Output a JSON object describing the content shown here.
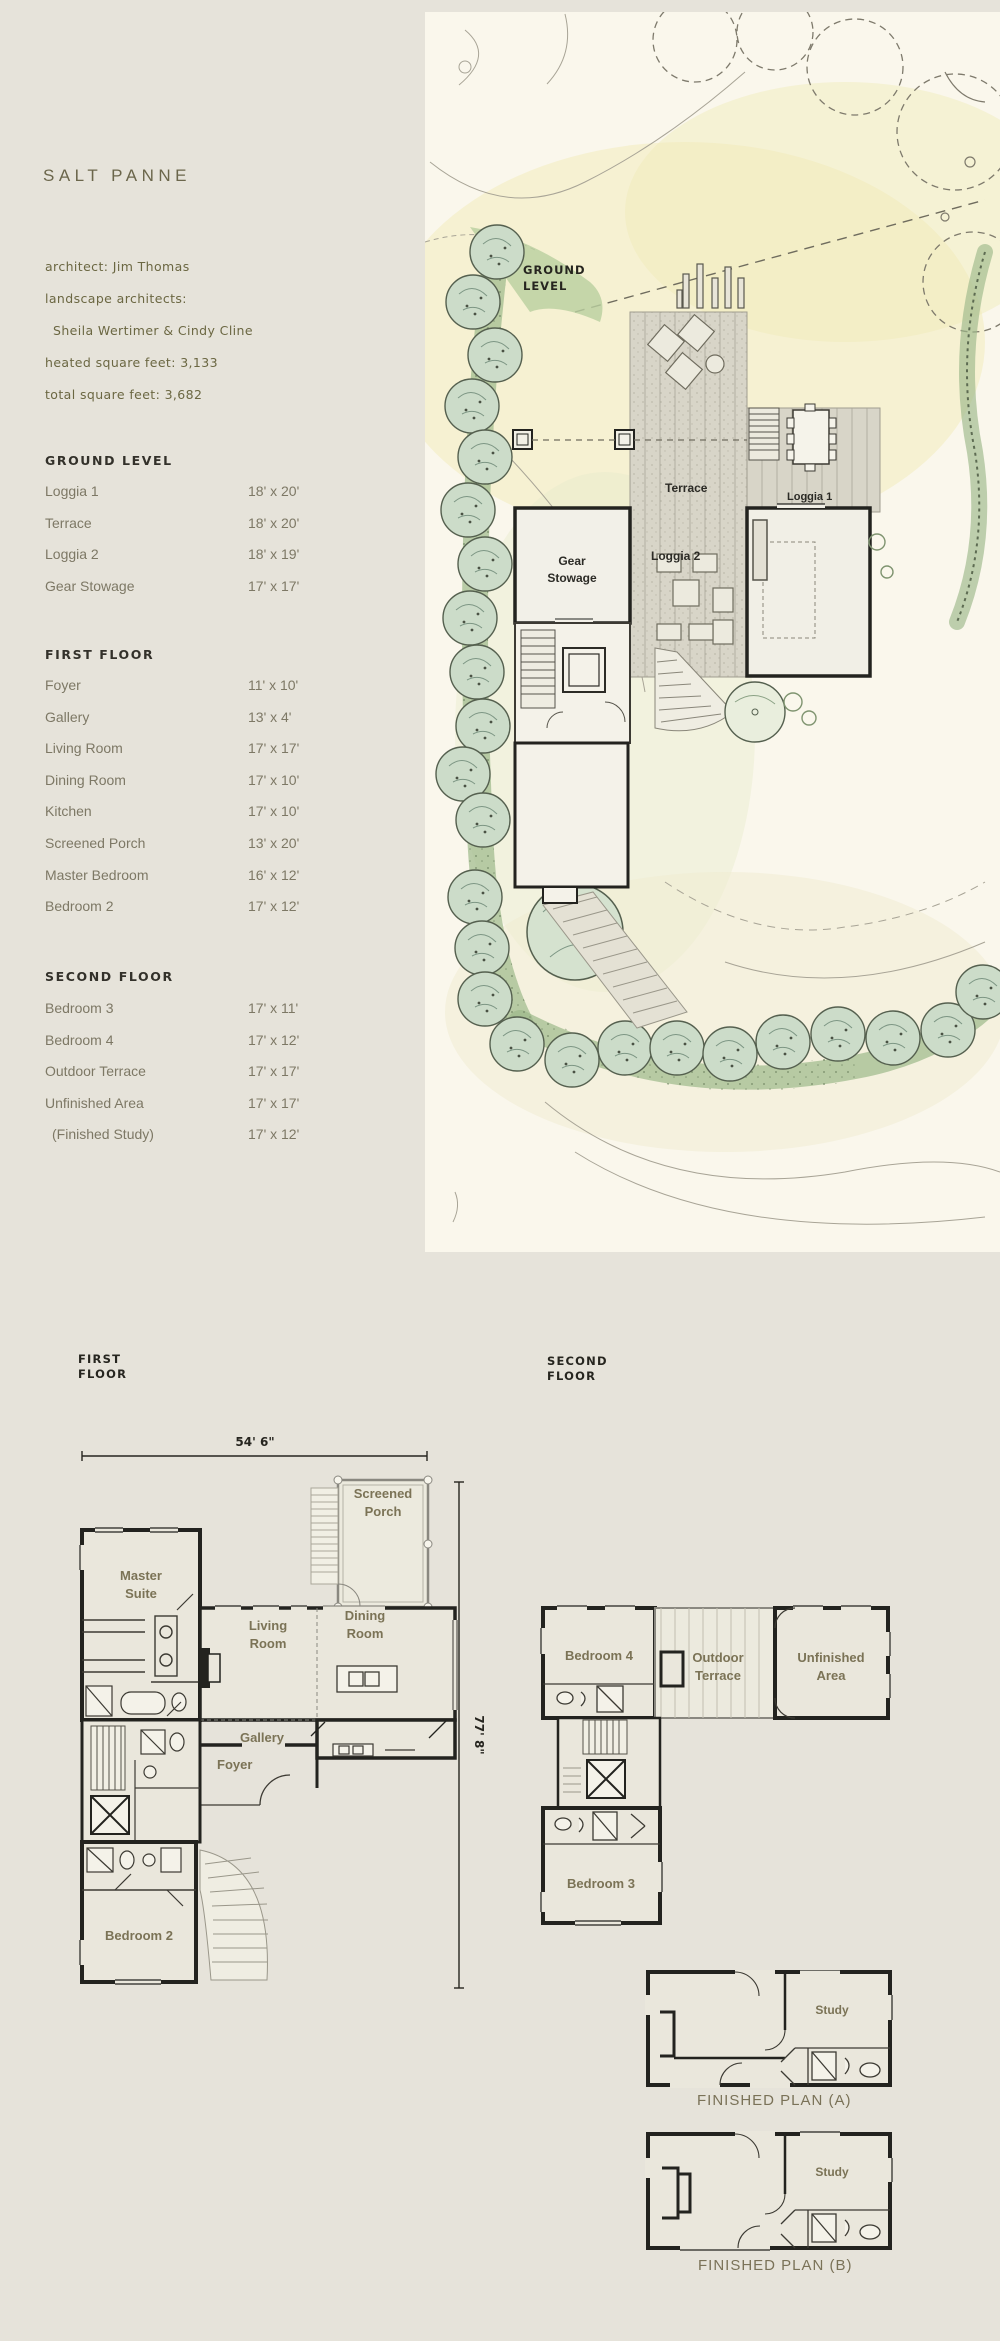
{
  "page": {
    "title": "SALT PANNE"
  },
  "info": {
    "line1": "architect: Jim Thomas",
    "line2": "landscape architects:",
    "line3": "Sheila Wertimer & Cindy Cline",
    "line4": "heated square feet: 3,133",
    "line5": "total square feet: 3,682"
  },
  "room_tables": [
    {
      "header": "GROUND LEVEL",
      "rows": [
        {
          "name": "Loggia 1",
          "dim": "18' x 20'"
        },
        {
          "name": "Terrace",
          "dim": "18' x 20'"
        },
        {
          "name": "Loggia 2",
          "dim": "18' x 19'"
        },
        {
          "name": "Gear Stowage",
          "dim": "17' x 17'"
        }
      ]
    },
    {
      "header": "FIRST FLOOR",
      "rows": [
        {
          "name": "Foyer",
          "dim": "11' x 10'"
        },
        {
          "name": "Gallery",
          "dim": "13' x 4'"
        },
        {
          "name": "Living Room",
          "dim": "17' x 17'"
        },
        {
          "name": "Dining Room",
          "dim": "17' x 10'"
        },
        {
          "name": "Kitchen",
          "dim": "17' x 10'"
        },
        {
          "name": "Screened Porch",
          "dim": "13' x 20'"
        },
        {
          "name": "Master Bedroom",
          "dim": "16' x 12'"
        },
        {
          "name": "Bedroom 2",
          "dim": "17' x 12'"
        }
      ]
    },
    {
      "header": "SECOND FLOOR",
      "rows": [
        {
          "name": "Bedroom 3",
          "dim": "17' x 11'"
        },
        {
          "name": "Bedroom 4",
          "dim": "17' x 12'"
        },
        {
          "name": "Outdoor Terrace",
          "dim": "17' x 17'"
        },
        {
          "name": "Unfinished Area",
          "dim": "17' x 17'"
        },
        {
          "name": "(Finished Study)",
          "dim": "17' x 12'"
        }
      ]
    }
  ],
  "site_plan": {
    "ground_label_1": "GROUND",
    "ground_label_2": "LEVEL",
    "terrace": "Terrace",
    "loggia1": "Loggia 1",
    "loggia2": "Loggia 2",
    "gear_1": "Gear",
    "gear_2": "Stowage"
  },
  "first_floor": {
    "title": "FIRST\nFLOOR",
    "width_dim": "54' 6\"",
    "height_dim": "77' 8\"",
    "master_1": "Master",
    "master_2": "Suite",
    "living_1": "Living",
    "living_2": "Room",
    "dining_1": "Dining",
    "dining_2": "Room",
    "kitchen": "Kitchen",
    "gallery": "Gallery",
    "foyer": "Foyer",
    "porch_1": "Screened",
    "porch_2": "Porch",
    "bedroom2": "Bedroom 2"
  },
  "second_floor": {
    "title": "SECOND\nFLOOR",
    "bedroom4": "Bedroom 4",
    "terrace_1": "Outdoor",
    "terrace_2": "Terrace",
    "unfinished_1": "Unfinished",
    "unfinished_2": "Area",
    "bedroom3": "Bedroom 3"
  },
  "finished_a": {
    "study": "Study",
    "caption": "FINISHED PLAN (A)"
  },
  "finished_b": {
    "study": "Study",
    "caption": "FINISHED PLAN (B)"
  },
  "colors": {
    "page_bg": "#e6e3da",
    "paper": "#faf7ec",
    "olive_text": "#6b6742",
    "room_text": "#7d7865",
    "wall": "#23231f",
    "tree_fill": "#ccdcc9",
    "hedge": "#8fae7e",
    "wash_yellow": "#f2ecbe"
  }
}
